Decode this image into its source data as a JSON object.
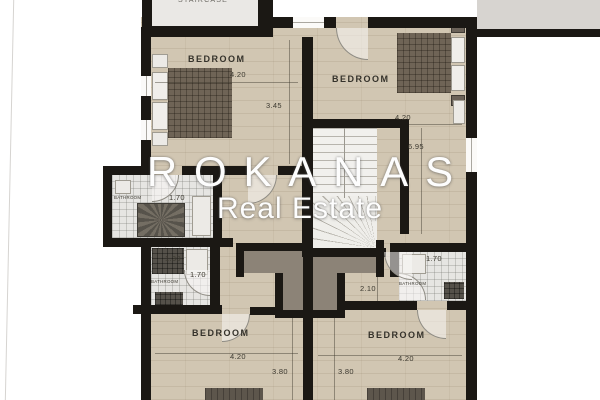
{
  "watermark": {
    "title": "ROKANAS",
    "subtitle": "Real Estate"
  },
  "rooms": {
    "staircase": {
      "label": "STAIRCASE"
    },
    "bedroom_top_left": {
      "label": "BEDROOM",
      "dim_width": "4.20",
      "dim_height": "3.45"
    },
    "bedroom_top_right": {
      "label": "BEDROOM",
      "dim_width": "4.20",
      "dim_height": "6.95"
    },
    "bathroom_upper_left": {
      "label": "BATHROOM",
      "dim": "1.70"
    },
    "bathroom_lower_left": {
      "label": "BATHROOM",
      "dim_width": "1.30",
      "dim_door": "1.70"
    },
    "bathroom_right": {
      "label": "BATHROOM",
      "dim": "1.70"
    },
    "hallway_right": {
      "dim": "2.10"
    },
    "bedroom_bottom_left": {
      "label": "BEDROOM",
      "dim_width": "4.20",
      "dim_height": "3.80"
    },
    "bedroom_bottom_right": {
      "label": "BEDROOM",
      "dim_width": "4.20",
      "dim_height": "3.80"
    }
  },
  "colors": {
    "wall": "#1b1814",
    "floor_wood": "#d1c6b2",
    "floor_tile": "#e6e5e2",
    "stair_room": "#eae8e5",
    "terrace_gray": "#8c8377",
    "bed_dark": "#6f6456",
    "watermark_text": "#fdfdfd",
    "background": "#ffffff"
  }
}
